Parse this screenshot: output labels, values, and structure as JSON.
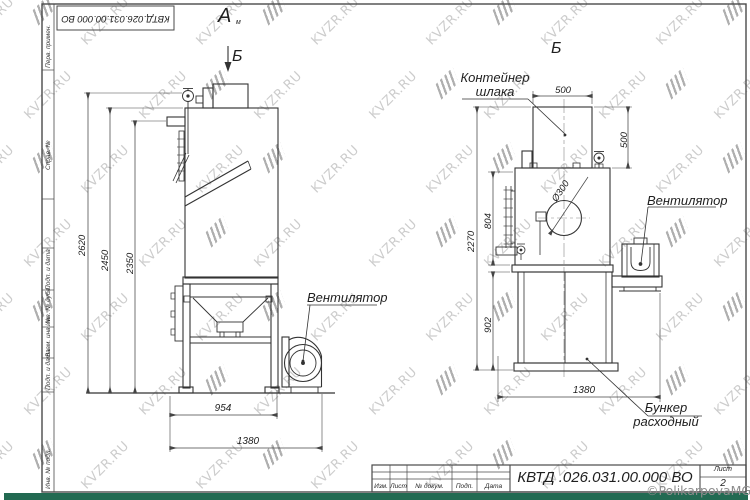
{
  "watermark": {
    "text": "KVZR.RU",
    "copyright": "©PolikarpovaMG2021"
  },
  "frame": {
    "stamp": "КВТД.026.031.00.000 ВО",
    "sidebar_items": [
      "Перв. примен.",
      "Справ. №",
      "Подп. и дата",
      "Инв. № дубл.",
      "Взам. инв. №",
      "Подп. и дата",
      "Инв. № подл."
    ]
  },
  "left_view": {
    "view_label": "А",
    "view_label_sub": "м",
    "section_label": "Б",
    "fan_label": "Вентилятор",
    "dim_2620": "2620",
    "dim_2450": "2450",
    "dim_2350": "2350",
    "dim_954": "954",
    "dim_1380": "1380"
  },
  "right_view": {
    "view_label": "Б",
    "container_line1": "Контейнер",
    "container_line2": "шлака",
    "fan_label": "Вентилятор",
    "bunker_line1": "Бункер",
    "bunker_line2": "расходный",
    "dim_500_top": "500",
    "dim_500_right": "500",
    "dim_804": "804",
    "dim_2270": "2270",
    "dim_902": "902",
    "dim_1380": "1380",
    "dim_dia": "Ø300"
  },
  "title_block": {
    "doc_number": "КВТД .026.031.00.000  ВО",
    "col_izm": "Изм.",
    "col_list": "Лист",
    "col_ndokum": "№ докум.",
    "col_podp": "Подп.",
    "col_data": "Дата",
    "sheet_label": "Лист",
    "sheet_number": "2"
  },
  "bottom_bar_color": "#226a52"
}
